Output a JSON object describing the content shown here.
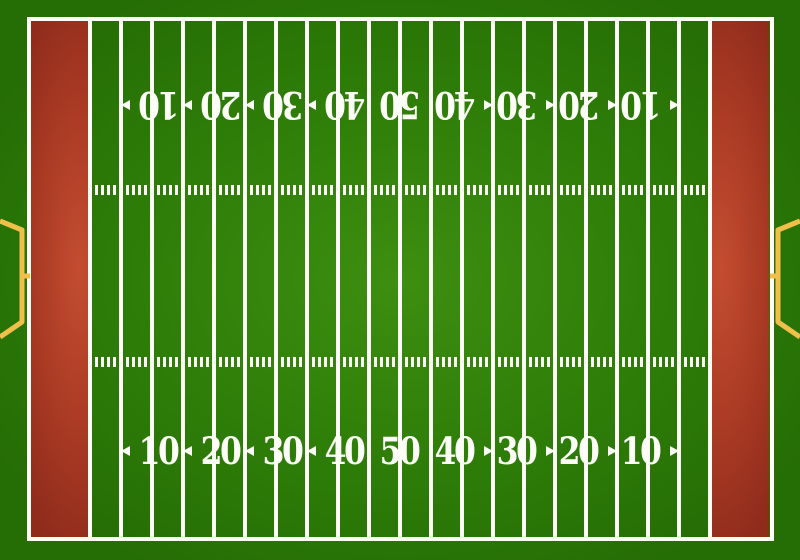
{
  "field": {
    "type": "american-football-field-top-view",
    "yard_numbers": [
      "10",
      "20",
      "30",
      "40",
      "50",
      "40",
      "30",
      "20",
      "10"
    ],
    "arrow_directions": [
      "left",
      "left",
      "left",
      "left",
      "none",
      "right",
      "right",
      "right",
      "right"
    ],
    "number_rows": [
      {
        "position": "top",
        "orientation": "inverted"
      },
      {
        "position": "bottom",
        "orientation": "upright"
      }
    ],
    "yard_line_count": 21,
    "hash_marks_per_segment": 4,
    "hash_rows": 2,
    "endzones": [
      "left",
      "right"
    ],
    "goalposts": [
      "left",
      "right"
    ],
    "colors": {
      "grass_center": "#3e8e11",
      "grass_edge": "#256d05",
      "endzone_bright": "#c44d30",
      "endzone_dark": "#8e2b1b",
      "line_white": "#fdfdf8",
      "goalpost_gold": "#f1c04a"
    }
  }
}
